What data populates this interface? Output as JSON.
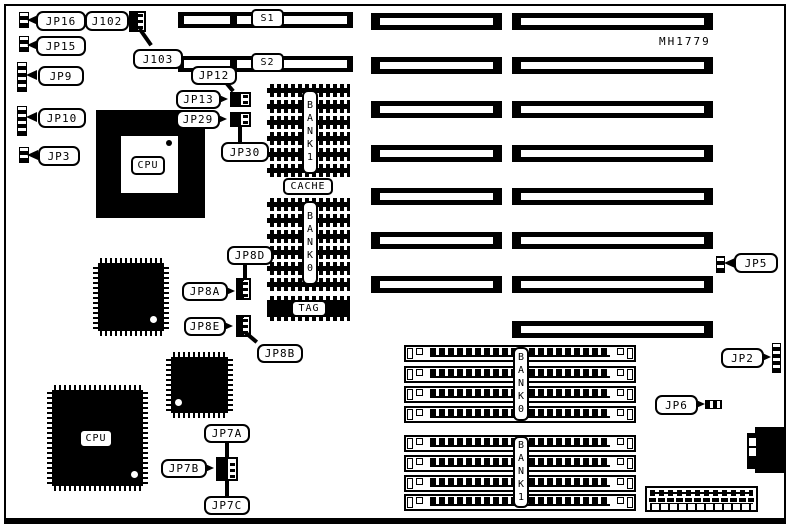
{
  "board": {
    "part_number": "MH1779"
  },
  "callouts": {
    "jp16": "JP16",
    "jp15": "JP15",
    "j102": "J102",
    "j103": "J103",
    "jp9": "JP9",
    "jp10": "JP10",
    "jp3": "JP3",
    "jp12": "JP12",
    "jp13": "JP13",
    "jp29": "JP29",
    "jp30": "JP30",
    "s1": "S1",
    "s2": "S2",
    "cpu_socket": "CPU",
    "cpu_qfp": "CPU",
    "cache": "CACHE",
    "tag": "TAG",
    "cache_bank1": "BANK1",
    "cache_bank0": "BANK0",
    "simm_bank0": "BANK0",
    "simm_bank1": "BANK1",
    "jp8d": "JP8D",
    "jp8a": "JP8A",
    "jp8e": "JP8E",
    "jp8b": "JP8B",
    "jp7a": "JP7A",
    "jp7b": "JP7B",
    "jp7c": "JP7C",
    "jp5": "JP5",
    "jp2": "JP2",
    "jp6": "JP6"
  }
}
